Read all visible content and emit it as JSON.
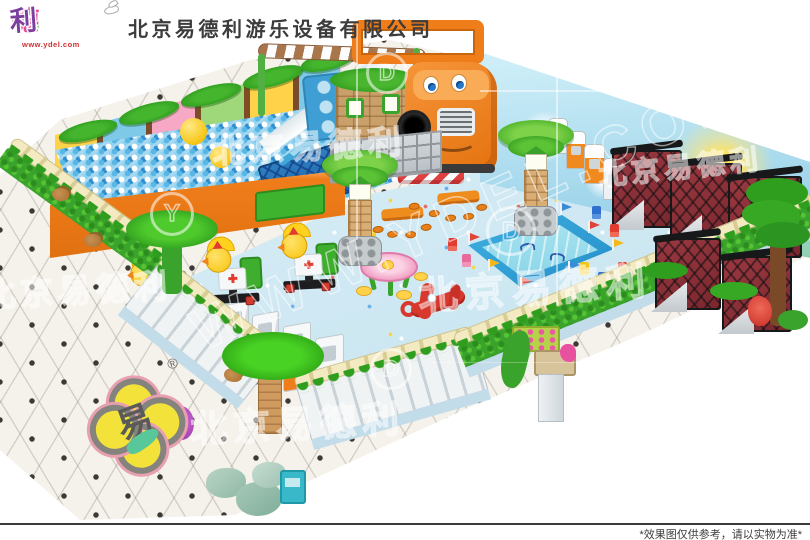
{
  "header": {
    "company_name": "北京易德利游乐设备有限公司",
    "logo": {
      "char_1": "易",
      "char_1_color": "#3cb52e",
      "char_2": "德",
      "char_2_color": "#e8489a",
      "char_3": "利",
      "char_3_color": "#7b3fa0",
      "url_text": "www.ydel.com",
      "mascot_icon": "dove-icon"
    }
  },
  "watermark": {
    "company_text": "北京易德利",
    "site_text": "WWW.YDEL.COM",
    "ring_letter_1": "Y",
    "ring_letter_2": "D",
    "ring_letter_3": "D",
    "ring_letter_4": "D"
  },
  "floor_logo": {
    "glyph": "易",
    "registered_symbol": "®"
  },
  "footer": {
    "disclaimer": "*效果图仅供参考，请以实物为准*"
  },
  "scene": {
    "type": "indoor-playground-3d-render",
    "palette": {
      "accent_orange": "#ef7d1a",
      "play_floor_blue": "#cfe8f2",
      "ball_blue": "#59b7e6",
      "hedge_green": "#3aa32c",
      "rope_cream": "#f0e6ba",
      "cage_maroon": "#8a2f36",
      "pool_blue": "#2e9ed6",
      "tile_white": "#f5f2ec",
      "mural_sky": "#bfe6f4"
    },
    "objects": [
      "ball-pit",
      "slide",
      "cartoon-truck-structure",
      "playhouse",
      "storage-cubbies",
      "capsule-machine-row",
      "swing-cages",
      "water-pool",
      "rocking-rides",
      "flower-table",
      "plane-ride",
      "dining-table-sets",
      "kids-chairs",
      "arcade-machines",
      "palm-tree-columns",
      "hedge-fence",
      "white-panel-fence",
      "mural-wall",
      "tile-floor",
      "rock-decor"
    ]
  }
}
